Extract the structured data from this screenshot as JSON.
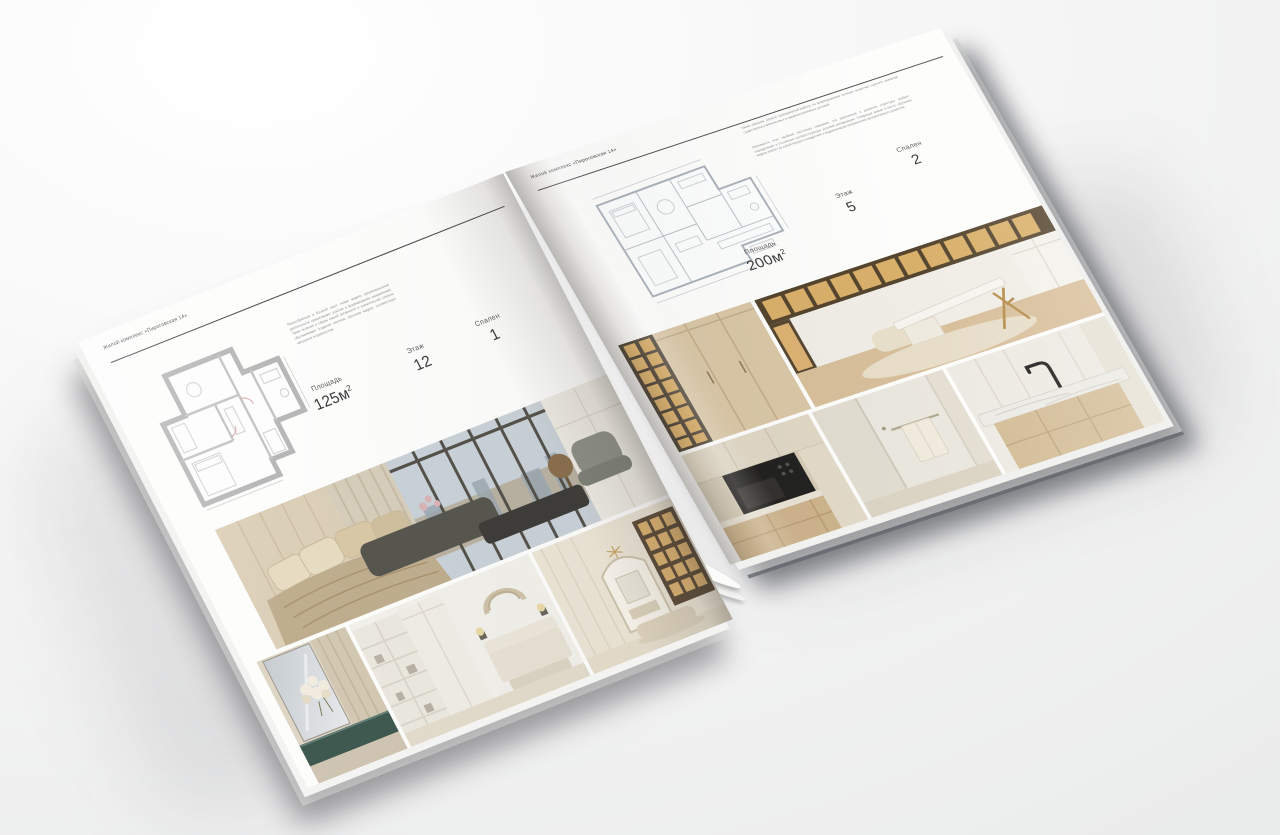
{
  "brochure": {
    "page_left": {
      "header": "Жилой комплекс «Пироговская 14»",
      "paragraph": "Разнообразный и богатый опыт: новая модель организационной деятельности предполагает участие в формировании направлений. Такая позиция и сфера нашей активности в значительной степени обуславливает создание системы обучения кадров, соответствует насущным потребностям.",
      "specs": {
        "area_label": "Площадь",
        "area_value": "125м",
        "area_sup": "2",
        "floor_label": "Этаж",
        "floor_value": "12",
        "bedrooms_label": "Спален",
        "bedrooms_value": "1"
      }
    },
    "page_right": {
      "header": "Жилой комплекс «Пироговская 14»",
      "paragraph_1": "Таким образом, начало повседневной работы по формированию позиции позволяет оценить значение существенных финансовых и административных условий.",
      "paragraph_2": "Значимость этих проблем настолько очевидна, что укрепление и развитие структуры требует определения и уточнения соответствующих условий активизации. Товарищи! рамки и место обучения кадров влечет за собой процесс внедрения и модернизации направлений прогрессивного развития.",
      "specs": {
        "area_label": "Площадь",
        "area_value": "200м",
        "area_sup": "2",
        "floor_label": "Этаж",
        "floor_value": "5",
        "bedrooms_label": "Спален",
        "bedrooms_value": "2"
      }
    },
    "palette": {
      "paper": "#fdfdfc",
      "text": "#4a4a4a",
      "rule": "#4c4c4c",
      "teal_console": "#3f5950",
      "amber_shelf": "#ddb26d",
      "wood": "#d9c7a7"
    }
  }
}
